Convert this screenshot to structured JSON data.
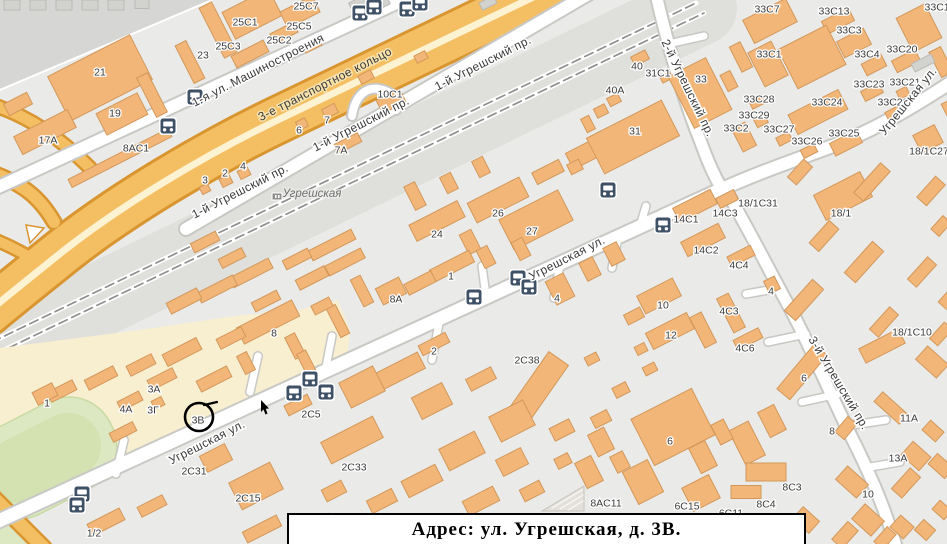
{
  "caption": {
    "text": "Адрес: ул. Угрешская, д. 3В."
  },
  "marker": {
    "label": "3В",
    "x": 199,
    "y": 417,
    "r": 14
  },
  "station": {
    "name": "Угрешская",
    "x": 312,
    "y": 193
  },
  "colors": {
    "bg": "#eaeae8",
    "dark_zone": "#d6d6d4",
    "rail_corridor": "#dfdfdc",
    "beige_zone": "#f8eed0",
    "green": "#dce8c2",
    "green_inner": "#d3e2b0",
    "road_fill": "#ffffff",
    "road_casing": "#c8c8c5",
    "highway_fill": "#f4bf63",
    "highway_casing": "#d9952f",
    "highway_stripe": "#fdf2d2",
    "building_fill": "#f3b679",
    "building_stroke": "#d2985a",
    "gray_building_fill": "#d2d2cf",
    "gray_building_stroke": "#b9b9b6",
    "bus_icon": "#3f5166",
    "rail_dash": "#8f8f8f",
    "marker_ink": "#000000"
  },
  "streets": [
    {
      "name": "1-я ул. Машиностроения",
      "x": 258,
      "y": 70,
      "rot": -27,
      "hw": false
    },
    {
      "name": "3-е транспортное кольцо",
      "x": 325,
      "y": 84,
      "rot": -27,
      "hw": true
    },
    {
      "name": "1-й Угрешский пр.",
      "x": 483,
      "y": 63,
      "rot": -27,
      "hw": false
    },
    {
      "name": "1-й Угрешский пр.",
      "x": 361,
      "y": 124,
      "rot": -27,
      "hw": false
    },
    {
      "name": "1-й Угрешский пр.",
      "x": 240,
      "y": 191,
      "rot": -27,
      "hw": false
    },
    {
      "name": "2-й Угрешский пр.",
      "x": 688,
      "y": 88,
      "rot": 64,
      "hw": false
    },
    {
      "name": "Угрешская ул.",
      "x": 908,
      "y": 101,
      "rot": -51,
      "hw": false
    },
    {
      "name": "Угрешская ул.",
      "x": 567,
      "y": 258,
      "rot": -27,
      "hw": false
    },
    {
      "name": "Угрешская ул.",
      "x": 207,
      "y": 442,
      "rot": -27,
      "hw": false
    },
    {
      "name": "3-й Угрешский пр.",
      "x": 839,
      "y": 383,
      "rot": 59,
      "hw": false
    }
  ],
  "building_labels": [
    {
      "t": "21",
      "x": 100,
      "y": 72
    },
    {
      "t": "19",
      "x": 115,
      "y": 113
    },
    {
      "t": "17A",
      "x": 48,
      "y": 140
    },
    {
      "t": "8AC1",
      "x": 136,
      "y": 148
    },
    {
      "t": "23",
      "x": 203,
      "y": 55
    },
    {
      "t": "25C3",
      "x": 228,
      "y": 46
    },
    {
      "t": "25C1",
      "x": 245,
      "y": 22
    },
    {
      "t": "25C2",
      "x": 279,
      "y": 40
    },
    {
      "t": "25C5",
      "x": 299,
      "y": 26
    },
    {
      "t": "25C7",
      "x": 306,
      "y": 6
    },
    {
      "t": "3",
      "x": 205,
      "y": 180
    },
    {
      "t": "2",
      "x": 225,
      "y": 173
    },
    {
      "t": "4",
      "x": 243,
      "y": 166
    },
    {
      "t": "7A",
      "x": 341,
      "y": 150
    },
    {
      "t": "7",
      "x": 327,
      "y": 120
    },
    {
      "t": "6",
      "x": 299,
      "y": 130
    },
    {
      "t": "10C1",
      "x": 390,
      "y": 94
    },
    {
      "t": "40A",
      "x": 615,
      "y": 90
    },
    {
      "t": "40",
      "x": 637,
      "y": 66
    },
    {
      "t": "31C1",
      "x": 658,
      "y": 73
    },
    {
      "t": "33",
      "x": 701,
      "y": 79
    },
    {
      "t": "31",
      "x": 635,
      "y": 131
    },
    {
      "t": "33C7",
      "x": 767,
      "y": 9
    },
    {
      "t": "33C13",
      "x": 834,
      "y": 11
    },
    {
      "t": "33C14",
      "x": 940,
      "y": 7
    },
    {
      "t": "33C3",
      "x": 849,
      "y": 30
    },
    {
      "t": "33C1",
      "x": 769,
      "y": 54
    },
    {
      "t": "33C4",
      "x": 867,
      "y": 54
    },
    {
      "t": "33C20",
      "x": 902,
      "y": 49
    },
    {
      "t": "33C23",
      "x": 869,
      "y": 84
    },
    {
      "t": "33C21",
      "x": 905,
      "y": 82
    },
    {
      "t": "33C28",
      "x": 759,
      "y": 99
    },
    {
      "t": "33C24",
      "x": 827,
      "y": 102
    },
    {
      "t": "33C22",
      "x": 893,
      "y": 102
    },
    {
      "t": "33C29",
      "x": 754,
      "y": 115
    },
    {
      "t": "33C2",
      "x": 736,
      "y": 128
    },
    {
      "t": "33C27",
      "x": 779,
      "y": 129
    },
    {
      "t": "33C25",
      "x": 844,
      "y": 133
    },
    {
      "t": "33C26",
      "x": 807,
      "y": 141
    },
    {
      "t": "18/1C27",
      "x": 929,
      "y": 151
    },
    {
      "t": "18/1",
      "x": 841,
      "y": 213
    },
    {
      "t": "18/1C31",
      "x": 758,
      "y": 203
    },
    {
      "t": "14C3",
      "x": 725,
      "y": 213
    },
    {
      "t": "14C1",
      "x": 686,
      "y": 219
    },
    {
      "t": "14C2",
      "x": 706,
      "y": 250
    },
    {
      "t": "4C4",
      "x": 739,
      "y": 265
    },
    {
      "t": "4",
      "x": 771,
      "y": 291
    },
    {
      "t": "4C3",
      "x": 729,
      "y": 311
    },
    {
      "t": "10",
      "x": 663,
      "y": 305
    },
    {
      "t": "12",
      "x": 671,
      "y": 335
    },
    {
      "t": "4C6",
      "x": 745,
      "y": 348
    },
    {
      "t": "18/1C10",
      "x": 912,
      "y": 332
    },
    {
      "t": "26",
      "x": 498,
      "y": 213
    },
    {
      "t": "24",
      "x": 437,
      "y": 234
    },
    {
      "t": "27",
      "x": 532,
      "y": 231
    },
    {
      "t": "1",
      "x": 451,
      "y": 276
    },
    {
      "t": "8A",
      "x": 396,
      "y": 299
    },
    {
      "t": "4",
      "x": 557,
      "y": 298
    },
    {
      "t": "8",
      "x": 274,
      "y": 333
    },
    {
      "t": "2",
      "x": 434,
      "y": 351
    },
    {
      "t": "2C38",
      "x": 527,
      "y": 360
    },
    {
      "t": "2C5",
      "x": 311,
      "y": 414
    },
    {
      "t": "2C33",
      "x": 354,
      "y": 467
    },
    {
      "t": "2C31",
      "x": 194,
      "y": 471
    },
    {
      "t": "2C15",
      "x": 248,
      "y": 498
    },
    {
      "t": "1/2",
      "x": 94,
      "y": 533
    },
    {
      "t": "1",
      "x": 47,
      "y": 403
    },
    {
      "t": "3A",
      "x": 154,
      "y": 389
    },
    {
      "t": "4A",
      "x": 126,
      "y": 409
    },
    {
      "t": "3Г",
      "x": 153,
      "y": 410
    },
    {
      "t": "3В",
      "x": 198,
      "y": 420
    },
    {
      "t": "6",
      "x": 670,
      "y": 441
    },
    {
      "t": "6",
      "x": 804,
      "y": 378
    },
    {
      "t": "11A",
      "x": 909,
      "y": 418
    },
    {
      "t": "8",
      "x": 832,
      "y": 431
    },
    {
      "t": "13A",
      "x": 898,
      "y": 458
    },
    {
      "t": "10",
      "x": 868,
      "y": 494
    },
    {
      "t": "8C3",
      "x": 792,
      "y": 487
    },
    {
      "t": "8C4",
      "x": 766,
      "y": 504
    },
    {
      "t": "6C15",
      "x": 687,
      "y": 506
    },
    {
      "t": "6C11",
      "x": 731,
      "y": 513
    },
    {
      "t": "8AC11",
      "x": 606,
      "y": 503
    }
  ],
  "buildings": [
    [
      100,
      78,
      92,
      50,
      -27
    ],
    [
      152,
      95,
      12,
      44,
      -27
    ],
    [
      122,
      114,
      46,
      24,
      -27
    ],
    [
      45,
      132,
      60,
      20,
      -27
    ],
    [
      18,
      104,
      26,
      13,
      -27
    ],
    [
      120,
      158,
      112,
      9,
      -27
    ],
    [
      218,
      30,
      14,
      56,
      -27
    ],
    [
      252,
      14,
      52,
      30,
      -27
    ],
    [
      300,
      12,
      36,
      18,
      -27
    ],
    [
      284,
      33,
      26,
      11,
      -27
    ],
    [
      250,
      54,
      36,
      13,
      -27
    ],
    [
      190,
      62,
      12,
      42,
      -27
    ],
    [
      312,
      45,
      18,
      9,
      -27
    ],
    [
      205,
      189,
      9,
      8,
      -27
    ],
    [
      226,
      181,
      11,
      9,
      -27
    ],
    [
      244,
      173,
      11,
      9,
      -27
    ],
    [
      348,
      143,
      26,
      10,
      -27
    ],
    [
      330,
      111,
      14,
      10,
      -27
    ],
    [
      302,
      124,
      10,
      9,
      -27
    ],
    [
      391,
      101,
      26,
      15,
      -27
    ],
    [
      366,
      77,
      14,
      9,
      -27
    ],
    [
      421,
      57,
      12,
      8,
      -27
    ],
    [
      590,
      151,
      46,
      18,
      -27
    ],
    [
      548,
      172,
      30,
      13,
      -27
    ],
    [
      575,
      167,
      13,
      11,
      -27
    ],
    [
      498,
      200,
      58,
      22,
      -27
    ],
    [
      536,
      220,
      66,
      34,
      -27
    ],
    [
      437,
      221,
      54,
      18,
      -27
    ],
    [
      470,
      242,
      13,
      22,
      -27
    ],
    [
      415,
      196,
      12,
      26,
      -27
    ],
    [
      449,
      183,
      12,
      18,
      -27
    ],
    [
      481,
      167,
      12,
      18,
      -27
    ],
    [
      452,
      266,
      44,
      13,
      -27
    ],
    [
      486,
      257,
      12,
      20,
      -27
    ],
    [
      420,
      283,
      30,
      12,
      -27
    ],
    [
      391,
      291,
      26,
      18,
      -27
    ],
    [
      362,
      291,
      11,
      30,
      -27
    ],
    [
      345,
      262,
      40,
      11,
      -27
    ],
    [
      312,
      278,
      32,
      11,
      -27
    ],
    [
      332,
      245,
      48,
      11,
      -27
    ],
    [
      297,
      259,
      28,
      10,
      -27
    ],
    [
      251,
      273,
      44,
      11,
      -27
    ],
    [
      217,
      289,
      40,
      11,
      -27
    ],
    [
      266,
      301,
      28,
      10,
      -27
    ],
    [
      232,
      258,
      26,
      10,
      -27
    ],
    [
      184,
      301,
      34,
      12,
      -27
    ],
    [
      205,
      242,
      28,
      10,
      -27
    ],
    [
      560,
      289,
      20,
      26,
      -27
    ],
    [
      590,
      269,
      15,
      20,
      -27
    ],
    [
      614,
      254,
      15,
      20,
      -27
    ],
    [
      521,
      249,
      12,
      20,
      -27
    ],
    [
      633,
      137,
      84,
      40,
      -27
    ],
    [
      601,
      111,
      12,
      10,
      -27
    ],
    [
      614,
      100,
      12,
      9,
      -27
    ],
    [
      588,
      124,
      9,
      15,
      -27
    ],
    [
      640,
      58,
      16,
      10,
      -27
    ],
    [
      666,
      77,
      11,
      8,
      -27
    ],
    [
      700,
      93,
      42,
      58,
      -27
    ],
    [
      741,
      57,
      12,
      28,
      -27
    ],
    [
      770,
      21,
      48,
      26,
      -27
    ],
    [
      838,
      21,
      30,
      14,
      -27
    ],
    [
      812,
      57,
      54,
      44,
      -27
    ],
    [
      768,
      64,
      26,
      38,
      -27
    ],
    [
      854,
      43,
      30,
      18,
      -27
    ],
    [
      874,
      65,
      22,
      13,
      -27
    ],
    [
      906,
      61,
      26,
      13,
      -27
    ],
    [
      729,
      81,
      11,
      18,
      -27
    ],
    [
      757,
      102,
      14,
      9,
      -27
    ],
    [
      818,
      112,
      56,
      22,
      -27
    ],
    [
      872,
      92,
      20,
      11,
      -27
    ],
    [
      903,
      93,
      11,
      9,
      -27
    ],
    [
      894,
      113,
      16,
      9,
      -27
    ],
    [
      761,
      121,
      12,
      9,
      -27
    ],
    [
      744,
      137,
      15,
      26,
      -27
    ],
    [
      784,
      139,
      14,
      9,
      -27
    ],
    [
      846,
      143,
      30,
      14,
      -27
    ],
    [
      809,
      151,
      15,
      9,
      -27
    ],
    [
      919,
      28,
      32,
      38,
      -27
    ],
    [
      941,
      62,
      13,
      28,
      -27
    ],
    [
      928,
      139,
      24,
      20,
      -27
    ],
    [
      952,
      110,
      14,
      20,
      -27
    ],
    [
      695,
      206,
      42,
      16,
      -27
    ],
    [
      727,
      199,
      20,
      11,
      -27
    ],
    [
      703,
      240,
      42,
      16,
      -27
    ],
    [
      741,
      256,
      26,
      11,
      -27
    ],
    [
      772,
      285,
      12,
      14,
      -27
    ],
    [
      731,
      313,
      38,
      13,
      63
    ],
    [
      748,
      339,
      28,
      11,
      -27
    ],
    [
      703,
      330,
      34,
      13,
      63
    ],
    [
      659,
      296,
      40,
      20,
      -27
    ],
    [
      670,
      331,
      46,
      18,
      -27
    ],
    [
      634,
      316,
      18,
      11,
      -27
    ],
    [
      843,
      196,
      52,
      28,
      -27
    ],
    [
      800,
      172,
      24,
      12,
      -48
    ],
    [
      872,
      182,
      40,
      13,
      -48
    ],
    [
      931,
      191,
      28,
      13,
      -48
    ],
    [
      824,
      236,
      30,
      13,
      -48
    ],
    [
      941,
      226,
      18,
      11,
      -48
    ],
    [
      864,
      262,
      42,
      15,
      -48
    ],
    [
      804,
      300,
      42,
      15,
      -48
    ],
    [
      922,
      272,
      30,
      12,
      -48
    ],
    [
      884,
      322,
      30,
      12,
      -48
    ],
    [
      941,
      334,
      22,
      11,
      -48
    ],
    [
      882,
      346,
      44,
      16,
      -27
    ],
    [
      948,
      300,
      16,
      12,
      -48
    ],
    [
      434,
      344,
      30,
      11,
      -27
    ],
    [
      538,
      388,
      72,
      24,
      -55
    ],
    [
      400,
      371,
      48,
      18,
      -27
    ],
    [
      362,
      387,
      38,
      28,
      -27
    ],
    [
      432,
      401,
      34,
      24,
      -27
    ],
    [
      481,
      379,
      28,
      13,
      -27
    ],
    [
      512,
      421,
      38,
      28,
      -27
    ],
    [
      352,
      440,
      58,
      24,
      -27
    ],
    [
      462,
      451,
      40,
      24,
      -27
    ],
    [
      512,
      462,
      28,
      18,
      -27
    ],
    [
      562,
      430,
      22,
      14,
      -27
    ],
    [
      601,
      419,
      18,
      12,
      -27
    ],
    [
      422,
      481,
      38,
      18,
      -27
    ],
    [
      481,
      501,
      34,
      16,
      -27
    ],
    [
      532,
      491,
      22,
      13,
      -27
    ],
    [
      382,
      501,
      28,
      14,
      -27
    ],
    [
      334,
      491,
      22,
      13,
      -27
    ],
    [
      563,
      461,
      15,
      11,
      -27
    ],
    [
      621,
      390,
      15,
      11,
      -27
    ],
    [
      650,
      369,
      13,
      9,
      -27
    ],
    [
      592,
      359,
      13,
      9,
      -27
    ],
    [
      641,
      349,
      11,
      9,
      -27
    ],
    [
      298,
      405,
      26,
      11,
      -27
    ],
    [
      216,
      458,
      28,
      18,
      -27
    ],
    [
      256,
      486,
      46,
      30,
      -27
    ],
    [
      106,
      522,
      36,
      13,
      -27
    ],
    [
      152,
      506,
      28,
      11,
      -27
    ],
    [
      262,
      529,
      38,
      12,
      -27
    ],
    [
      319,
      524,
      26,
      11,
      -27
    ],
    [
      601,
      442,
      18,
      24,
      -27
    ],
    [
      673,
      427,
      68,
      52,
      -27
    ],
    [
      802,
      372,
      58,
      17,
      -50
    ],
    [
      846,
      428,
      20,
      12,
      -50
    ],
    [
      772,
      421,
      18,
      28,
      -27
    ],
    [
      747,
      443,
      22,
      38,
      -27
    ],
    [
      722,
      432,
      14,
      22,
      -27
    ],
    [
      703,
      457,
      18,
      28,
      -27
    ],
    [
      766,
      472,
      40,
      18,
      0
    ],
    [
      746,
      492,
      30,
      13,
      0
    ],
    [
      701,
      493,
      30,
      26,
      -27
    ],
    [
      643,
      482,
      28,
      36,
      -27
    ],
    [
      620,
      462,
      14,
      18,
      -27
    ],
    [
      589,
      472,
      18,
      28,
      -27
    ],
    [
      891,
      408,
      13,
      34,
      -48
    ],
    [
      932,
      362,
      18,
      28,
      -48
    ],
    [
      916,
      456,
      18,
      24,
      -48
    ],
    [
      852,
      482,
      18,
      28,
      -48
    ],
    [
      906,
      483,
      28,
      14,
      -48
    ],
    [
      933,
      431,
      13,
      18,
      -48
    ],
    [
      941,
      466,
      14,
      22,
      -48
    ],
    [
      868,
      520,
      20,
      26,
      -48
    ],
    [
      806,
      520,
      16,
      22,
      -48
    ],
    [
      902,
      527,
      16,
      18,
      -48
    ],
    [
      845,
      535,
      24,
      14,
      -48
    ],
    [
      885,
      538,
      20,
      12,
      -48
    ],
    [
      925,
      530,
      14,
      16,
      -48
    ],
    [
      942,
      510,
      12,
      16,
      -48
    ],
    [
      268,
      322,
      62,
      18,
      -27
    ],
    [
      231,
      338,
      28,
      11,
      -27
    ],
    [
      182,
      352,
      38,
      13,
      -27
    ],
    [
      141,
      365,
      28,
      11,
      -27
    ],
    [
      101,
      378,
      32,
      11,
      -27
    ],
    [
      62,
      391,
      28,
      11,
      -27
    ],
    [
      45,
      394,
      22,
      14,
      -27
    ],
    [
      162,
      379,
      28,
      11,
      -27
    ],
    [
      130,
      401,
      24,
      10,
      -27
    ],
    [
      158,
      403,
      11,
      9,
      -27
    ],
    [
      214,
      379,
      34,
      12,
      -27
    ],
    [
      246,
      363,
      11,
      20,
      -27
    ],
    [
      295,
      346,
      11,
      24,
      -27
    ],
    [
      338,
      321,
      10,
      32,
      -27
    ],
    [
      306,
      362,
      10,
      22,
      -27
    ],
    [
      123,
      432,
      26,
      10,
      -27
    ],
    [
      322,
      306,
      20,
      10,
      -27
    ]
  ],
  "gray_buildings": [
    [
      12,
      5,
      16,
      10,
      0
    ],
    [
      38,
      5,
      16,
      10,
      0
    ],
    [
      64,
      5,
      16,
      10,
      0
    ],
    [
      90,
      5,
      16,
      10,
      0
    ],
    [
      116,
      5,
      16,
      10,
      0
    ],
    [
      142,
      4,
      14,
      9,
      0
    ],
    [
      358,
      4,
      16,
      10,
      -27
    ],
    [
      382,
      3,
      14,
      9,
      -27
    ],
    [
      412,
      3,
      14,
      8,
      -27
    ],
    [
      488,
      3,
      16,
      8,
      -27
    ],
    [
      923,
      63,
      22,
      9,
      -27
    ]
  ],
  "bus_stops": [
    [
      195,
      97
    ],
    [
      168,
      126
    ],
    [
      360,
      13
    ],
    [
      374,
      7
    ],
    [
      407,
      9
    ],
    [
      420,
      3
    ],
    [
      608,
      190
    ],
    [
      663,
      225
    ],
    [
      518,
      278
    ],
    [
      529,
      287
    ],
    [
      474,
      297
    ],
    [
      310,
      379
    ],
    [
      294,
      393
    ],
    [
      326,
      392
    ],
    [
      82,
      494
    ],
    [
      77,
      505
    ]
  ]
}
